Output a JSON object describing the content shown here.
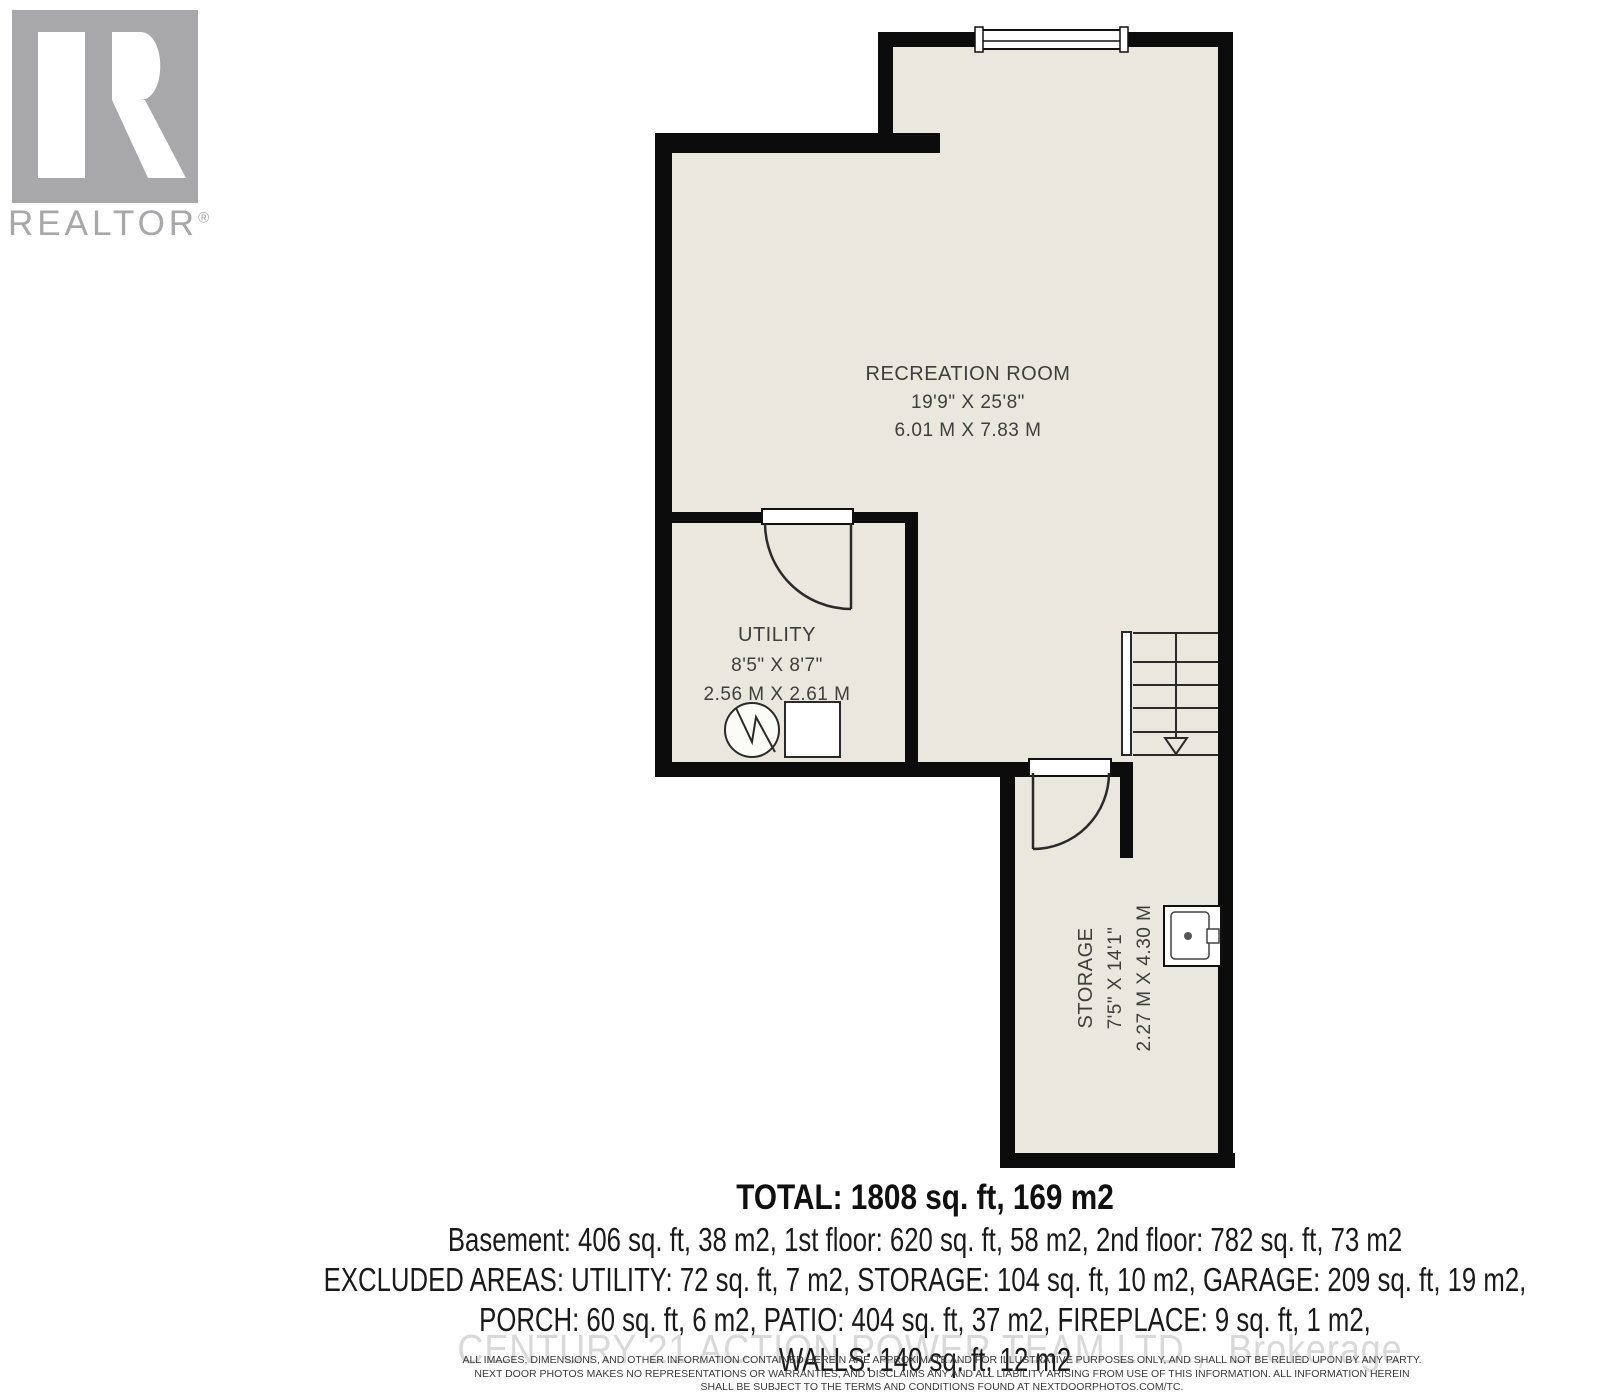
{
  "branding": {
    "logo_text": "REALTOR",
    "logo_reg": "®"
  },
  "rooms": {
    "recreation": {
      "name": "RECREATION ROOM",
      "imperial": "19'9\" X 25'8\"",
      "metric": "6.01 M X 7.83 M"
    },
    "utility": {
      "name": "UTILITY",
      "imperial": "8'5\" X 8'7\"",
      "metric": "2.56 M X 2.61 M"
    },
    "storage": {
      "name": "STORAGE",
      "imperial": "7'5\" X 14'1\"",
      "metric": "2.27 M X 4.30 M"
    }
  },
  "summary": {
    "total": "TOTAL: 1808 sq. ft, 169 m2",
    "floors": "Basement: 406 sq. ft, 38 m2, 1st floor: 620 sq. ft, 58 m2, 2nd floor: 782 sq. ft, 73 m2",
    "excluded_1": "EXCLUDED AREAS: UTILITY: 72 sq. ft, 7 m2, STORAGE: 104 sq. ft, 10 m2, GARAGE: 209 sq. ft, 19 m2,",
    "excluded_2": "PORCH: 60 sq. ft, 6 m2, PATIO: 404 sq. ft, 37 m2, FIREPLACE: 9 sq. ft, 1 m2,",
    "excluded_3": "WALLS: 140 sq. ft, 12 m2"
  },
  "watermark": "CENTURY 21 ACTION POWER TEAM LTD.,  Brokerage",
  "disclaimer": {
    "line1": "ALL IMAGES, DIMENSIONS, AND OTHER INFORMATION CONTAINED HEREIN ARE APPROXIMATE AND FOR ILLUSTRATIVE PURPOSES ONLY, AND SHALL NOT BE RELIED UPON BY ANY PARTY.",
    "line2": "NEXT DOOR PHOTOS MAKES NO REPRESENTATIONS OR WARRANTIES, AND DISCLAIMS ANY AND ALL LIABILITY ARISING FROM USE OF THIS INFORMATION. ALL INFORMATION HEREIN",
    "line3": "SHALL BE SUBJECT TO THE TERMS AND CONDITIONS FOUND AT NEXTDOORPHOTOS.COM/TC."
  },
  "colors": {
    "floor": "#e9e7de",
    "wall": "#0c0c0c",
    "label": "#3e3e3b",
    "logo_gray": "#a8a8aa",
    "watermark_gray": "#d9d9d9"
  }
}
